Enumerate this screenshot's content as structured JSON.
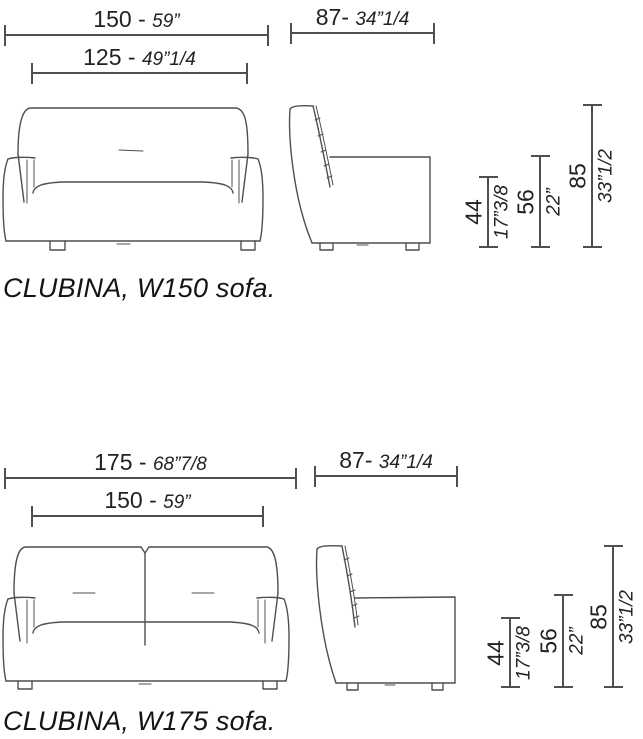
{
  "figures": [
    {
      "caption": "CLUBINA, W150 sofa.",
      "overall_width": {
        "cm": "150",
        "sep": " - ",
        "inch": "59”"
      },
      "inner_width": {
        "cm": "125",
        "sep": " - ",
        "inch": "49”1/4"
      },
      "depth": {
        "cm": "87",
        "sep": "- ",
        "inch": "34”1/4"
      },
      "seat_height": {
        "cm": "44",
        "inch": "17”3/8"
      },
      "arm_height": {
        "cm": "56",
        "inch": "22”"
      },
      "total_height": {
        "cm": "85",
        "inch": "33”1/2"
      }
    },
    {
      "caption": "CLUBINA, W175 sofa.",
      "overall_width": {
        "cm": "175",
        "sep": " - ",
        "inch": "68”7/8"
      },
      "inner_width": {
        "cm": "150",
        "sep": " - ",
        "inch": "59”"
      },
      "depth": {
        "cm": "87",
        "sep": "- ",
        "inch": "34”1/4"
      },
      "seat_height": {
        "cm": "44",
        "inch": "17”3/8"
      },
      "arm_height": {
        "cm": "56",
        "inch": "22”"
      },
      "total_height": {
        "cm": "85",
        "inch": "33”1/2"
      }
    }
  ]
}
